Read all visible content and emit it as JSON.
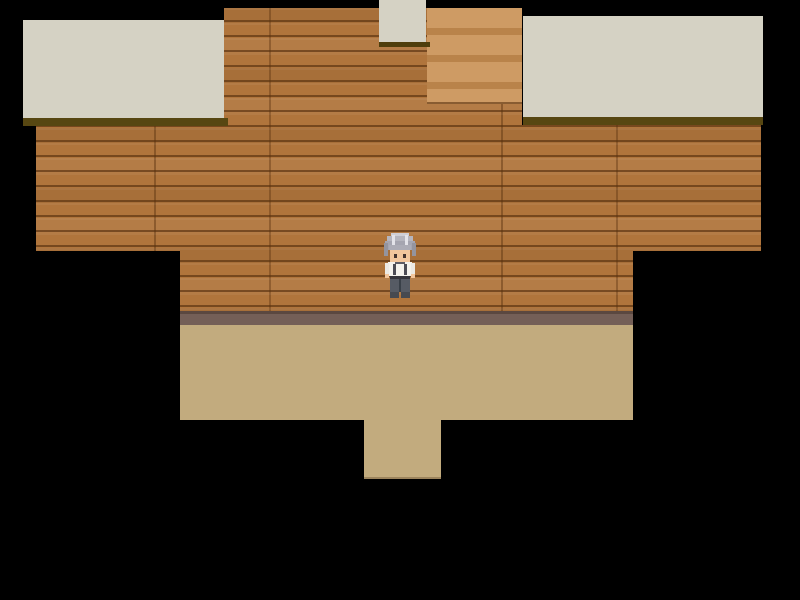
{
  "scene": {
    "description": "top-down rpg interior room with character",
    "viewport": {
      "width": 800,
      "height": 600
    },
    "palette": {
      "void": "#000000",
      "wall_wood": "#b0753c",
      "wall_plank_line": "#8a5526",
      "stairs_light": "#ce9b64",
      "stairs_dark": "#b9834a",
      "ceiling_panel": "#d5d2c4",
      "ceiling_shadow_line": "#574712",
      "tile_shadow": "#4f3e0c",
      "baseboard": "#745f57",
      "baseboard_top_line": "#5b4840",
      "floor": "#c2ab7e"
    },
    "regions": [
      {
        "name": "wood-wall",
        "texture": "wood",
        "x": 36,
        "y": 8,
        "w": 725,
        "h": 303,
        "interactable": false
      },
      {
        "name": "void-top-left",
        "texture": "flat",
        "x": 36,
        "y": 8,
        "w": 188,
        "h": 117,
        "color": "#000000",
        "interactable": false
      },
      {
        "name": "void-top-right",
        "texture": "flat",
        "x": 522,
        "y": 8,
        "w": 239,
        "h": 117,
        "color": "#000000",
        "interactable": false
      },
      {
        "name": "void-bottom-left",
        "texture": "flat",
        "x": 36,
        "y": 251,
        "w": 144,
        "h": 60,
        "color": "#000000",
        "interactable": false
      },
      {
        "name": "void-bottom-right",
        "texture": "flat",
        "x": 633,
        "y": 251,
        "w": 128,
        "h": 60,
        "color": "#000000",
        "interactable": false
      },
      {
        "name": "staircase-tiles",
        "texture": "stairs",
        "x": 427,
        "y": 8,
        "w": 95,
        "h": 96,
        "interactable": true
      },
      {
        "name": "doorway-ceiling-tile",
        "texture": "flat",
        "x": 379,
        "y": 0,
        "w": 47,
        "h": 42,
        "color": "#d5d2c4",
        "interactable": false
      },
      {
        "name": "doorway-tile-shadow",
        "texture": "flat",
        "x": 379,
        "y": 42,
        "w": 51,
        "h": 5,
        "color": "#4f3e0c",
        "interactable": false
      },
      {
        "name": "ceiling-panel-left",
        "texture": "flat",
        "x": 23,
        "y": 20,
        "w": 201,
        "h": 98,
        "color": "#d5d2c4",
        "interactable": false
      },
      {
        "name": "ceiling-shadow-left",
        "texture": "flat",
        "x": 23,
        "y": 118,
        "w": 205,
        "h": 8,
        "color": "#574712",
        "interactable": false
      },
      {
        "name": "ceiling-panel-right",
        "texture": "flat",
        "x": 523,
        "y": 16,
        "w": 240,
        "h": 101,
        "color": "#d5d2c4",
        "interactable": false
      },
      {
        "name": "ceiling-shadow-right",
        "texture": "flat",
        "x": 523,
        "y": 117,
        "w": 240,
        "h": 8,
        "color": "#574712",
        "interactable": false
      },
      {
        "name": "wall-baseboard",
        "texture": "baseboard",
        "x": 180,
        "y": 311,
        "w": 453,
        "h": 14,
        "interactable": false
      },
      {
        "name": "room-floor",
        "texture": "floor",
        "x": 180,
        "y": 325,
        "w": 453,
        "h": 95,
        "interactable": true
      },
      {
        "name": "doorway-floor-step",
        "texture": "floor",
        "x": 364,
        "y": 420,
        "w": 77,
        "h": 59,
        "edge": true,
        "interactable": true
      }
    ],
    "character": {
      "name": "old-man-npc",
      "facing": "down",
      "x": 383,
      "y": 233,
      "w": 34,
      "h": 65,
      "pixels": [
        {
          "x": 8,
          "y": 0,
          "w": 18,
          "h": 4,
          "c": "#cfcfd6"
        },
        {
          "x": 4,
          "y": 3,
          "w": 26,
          "h": 7,
          "c": "#b5b5be"
        },
        {
          "x": 2,
          "y": 8,
          "w": 30,
          "h": 9,
          "c": "#a5a5b0"
        },
        {
          "x": 9,
          "y": 2,
          "w": 3,
          "h": 11,
          "c": "#e3e3e9"
        },
        {
          "x": 22,
          "y": 2,
          "w": 3,
          "h": 11,
          "c": "#e3e3e9"
        },
        {
          "x": 1,
          "y": 10,
          "w": 4,
          "h": 13,
          "c": "#94949e"
        },
        {
          "x": 29,
          "y": 10,
          "w": 4,
          "h": 13,
          "c": "#94949e"
        },
        {
          "x": 7,
          "y": 16,
          "w": 20,
          "h": 13,
          "c": "#f2c69c"
        },
        {
          "x": 6,
          "y": 12,
          "w": 22,
          "h": 5,
          "c": "#acacb6"
        },
        {
          "x": 11,
          "y": 21,
          "w": 3,
          "h": 4,
          "c": "#43332e"
        },
        {
          "x": 20,
          "y": 21,
          "w": 3,
          "h": 4,
          "c": "#43332e"
        },
        {
          "x": 5,
          "y": 29,
          "w": 24,
          "h": 14,
          "c": "#f4f2ec"
        },
        {
          "x": 12,
          "y": 29,
          "w": 10,
          "h": 2,
          "c": "#5d5d66"
        },
        {
          "x": 10,
          "y": 31,
          "w": 3,
          "h": 11,
          "c": "#4c4c54"
        },
        {
          "x": 21,
          "y": 31,
          "w": 3,
          "h": 11,
          "c": "#4c4c54"
        },
        {
          "x": 2,
          "y": 30,
          "w": 4,
          "h": 11,
          "c": "#eceae4"
        },
        {
          "x": 28,
          "y": 30,
          "w": 4,
          "h": 11,
          "c": "#eceae4"
        },
        {
          "x": 2,
          "y": 41,
          "w": 4,
          "h": 4,
          "c": "#f2c69c"
        },
        {
          "x": 28,
          "y": 41,
          "w": 4,
          "h": 4,
          "c": "#f2c69c"
        },
        {
          "x": 7,
          "y": 43,
          "w": 20,
          "h": 3,
          "c": "#34343a"
        },
        {
          "x": 7,
          "y": 46,
          "w": 20,
          "h": 13,
          "c": "#565b64"
        },
        {
          "x": 16,
          "y": 46,
          "w": 2,
          "h": 13,
          "c": "#394048"
        },
        {
          "x": 7,
          "y": 59,
          "w": 9,
          "h": 6,
          "c": "#474a50"
        },
        {
          "x": 18,
          "y": 59,
          "w": 9,
          "h": 6,
          "c": "#474a50"
        }
      ]
    }
  }
}
